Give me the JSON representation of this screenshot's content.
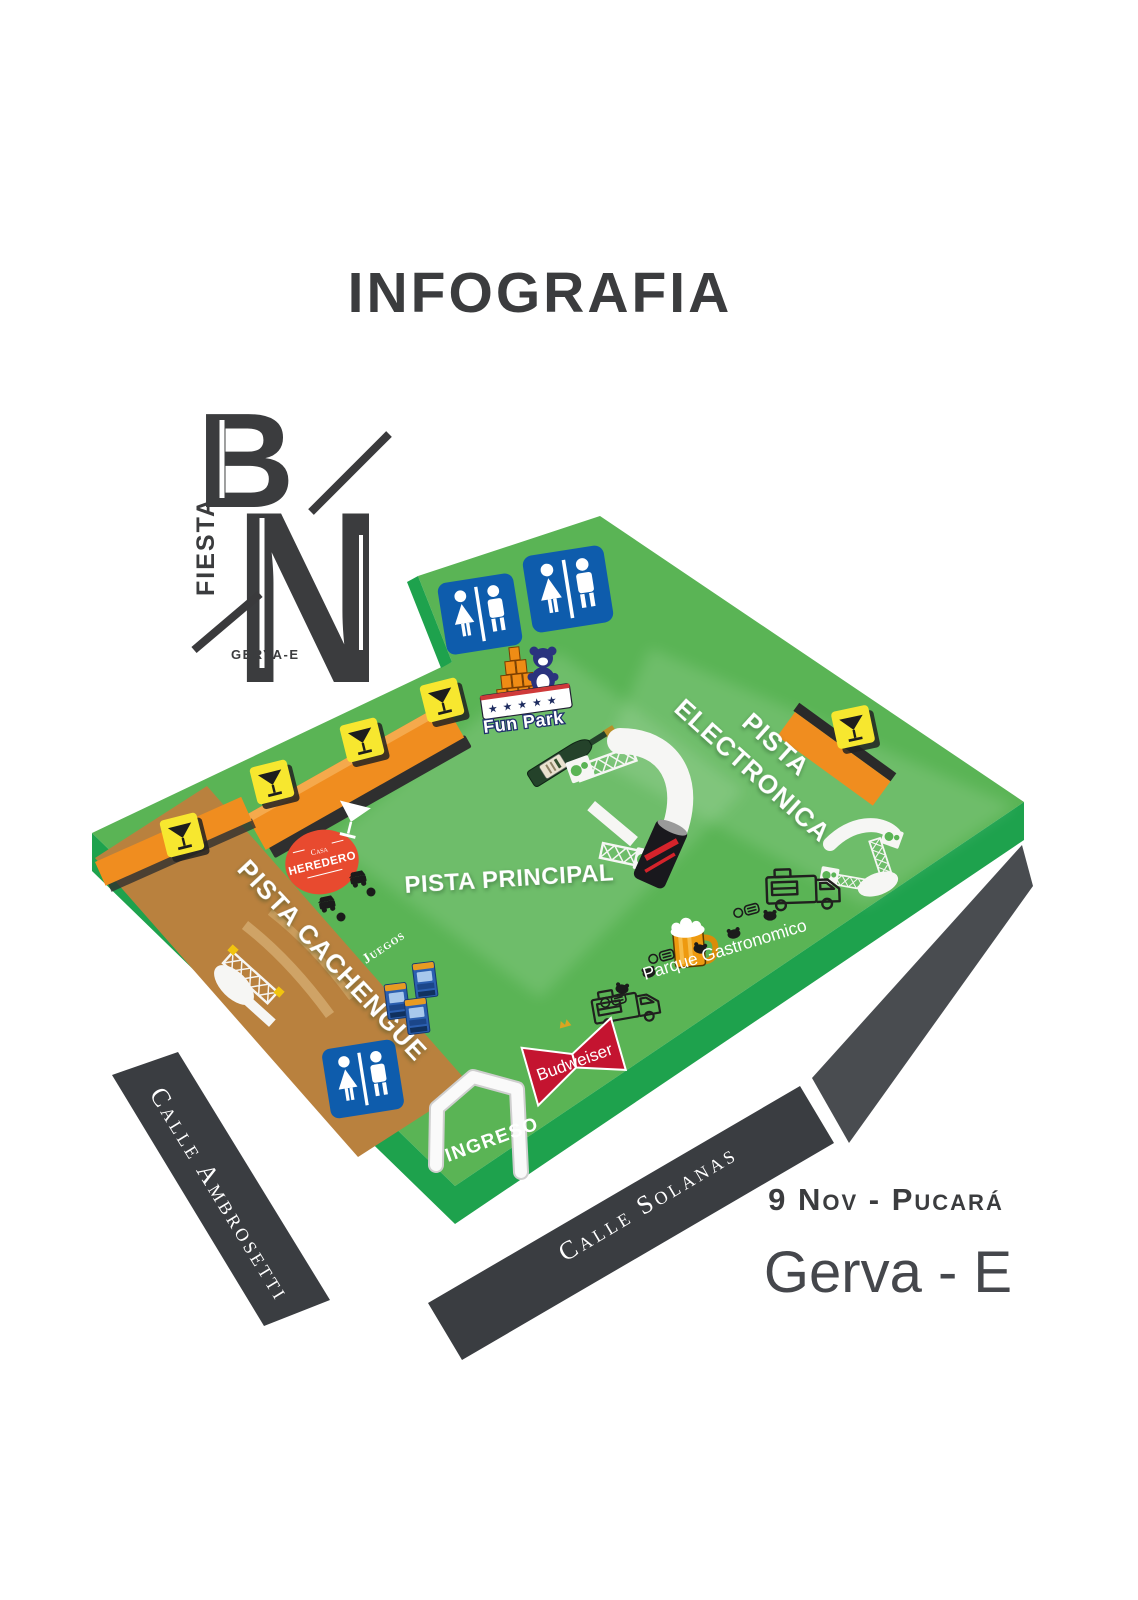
{
  "title": "INFOGRAFIA",
  "logo": {
    "letter_b": "B",
    "letter_n": "N",
    "vertical": "FIESTA",
    "subtitle": "GERVA-E"
  },
  "map": {
    "areas": {
      "electronica_line1": "PISTA",
      "electronica_line2": "ELECTRONICA",
      "principal": "PISTA PRINCIPAL",
      "cachengue": "PISTA CACHENGUE"
    },
    "pois": {
      "fun_park": "Fun Park",
      "fun_park_stars": "★★★★★",
      "juegos": "Juegos",
      "parque_gastronomico": "Parque Gastronomico",
      "ingreso": "INGRESO",
      "herediero_casa": "Casa",
      "herediero": "HEREDERO",
      "budweiser": "Budweiser"
    },
    "streets": {
      "left": "Calle Ambrosetti",
      "bottom": "Calle Solanas"
    }
  },
  "footer": {
    "date": "9 Nov - Pucará",
    "artist": "Gerva - E"
  },
  "colors": {
    "field": "#5ab455",
    "field_edge": "#1ea24d",
    "cachengue": "#b9813e",
    "bar_orange": "#f08d1f",
    "sign_yellow": "#f7e72f",
    "restroom_blue": "#0e5cac",
    "ribbon": "#3a3d41",
    "ink": "#3b3c3e",
    "badge_red": "#e84a2f",
    "bud_red": "#c41430",
    "white_structure": "#f6f6f4"
  }
}
